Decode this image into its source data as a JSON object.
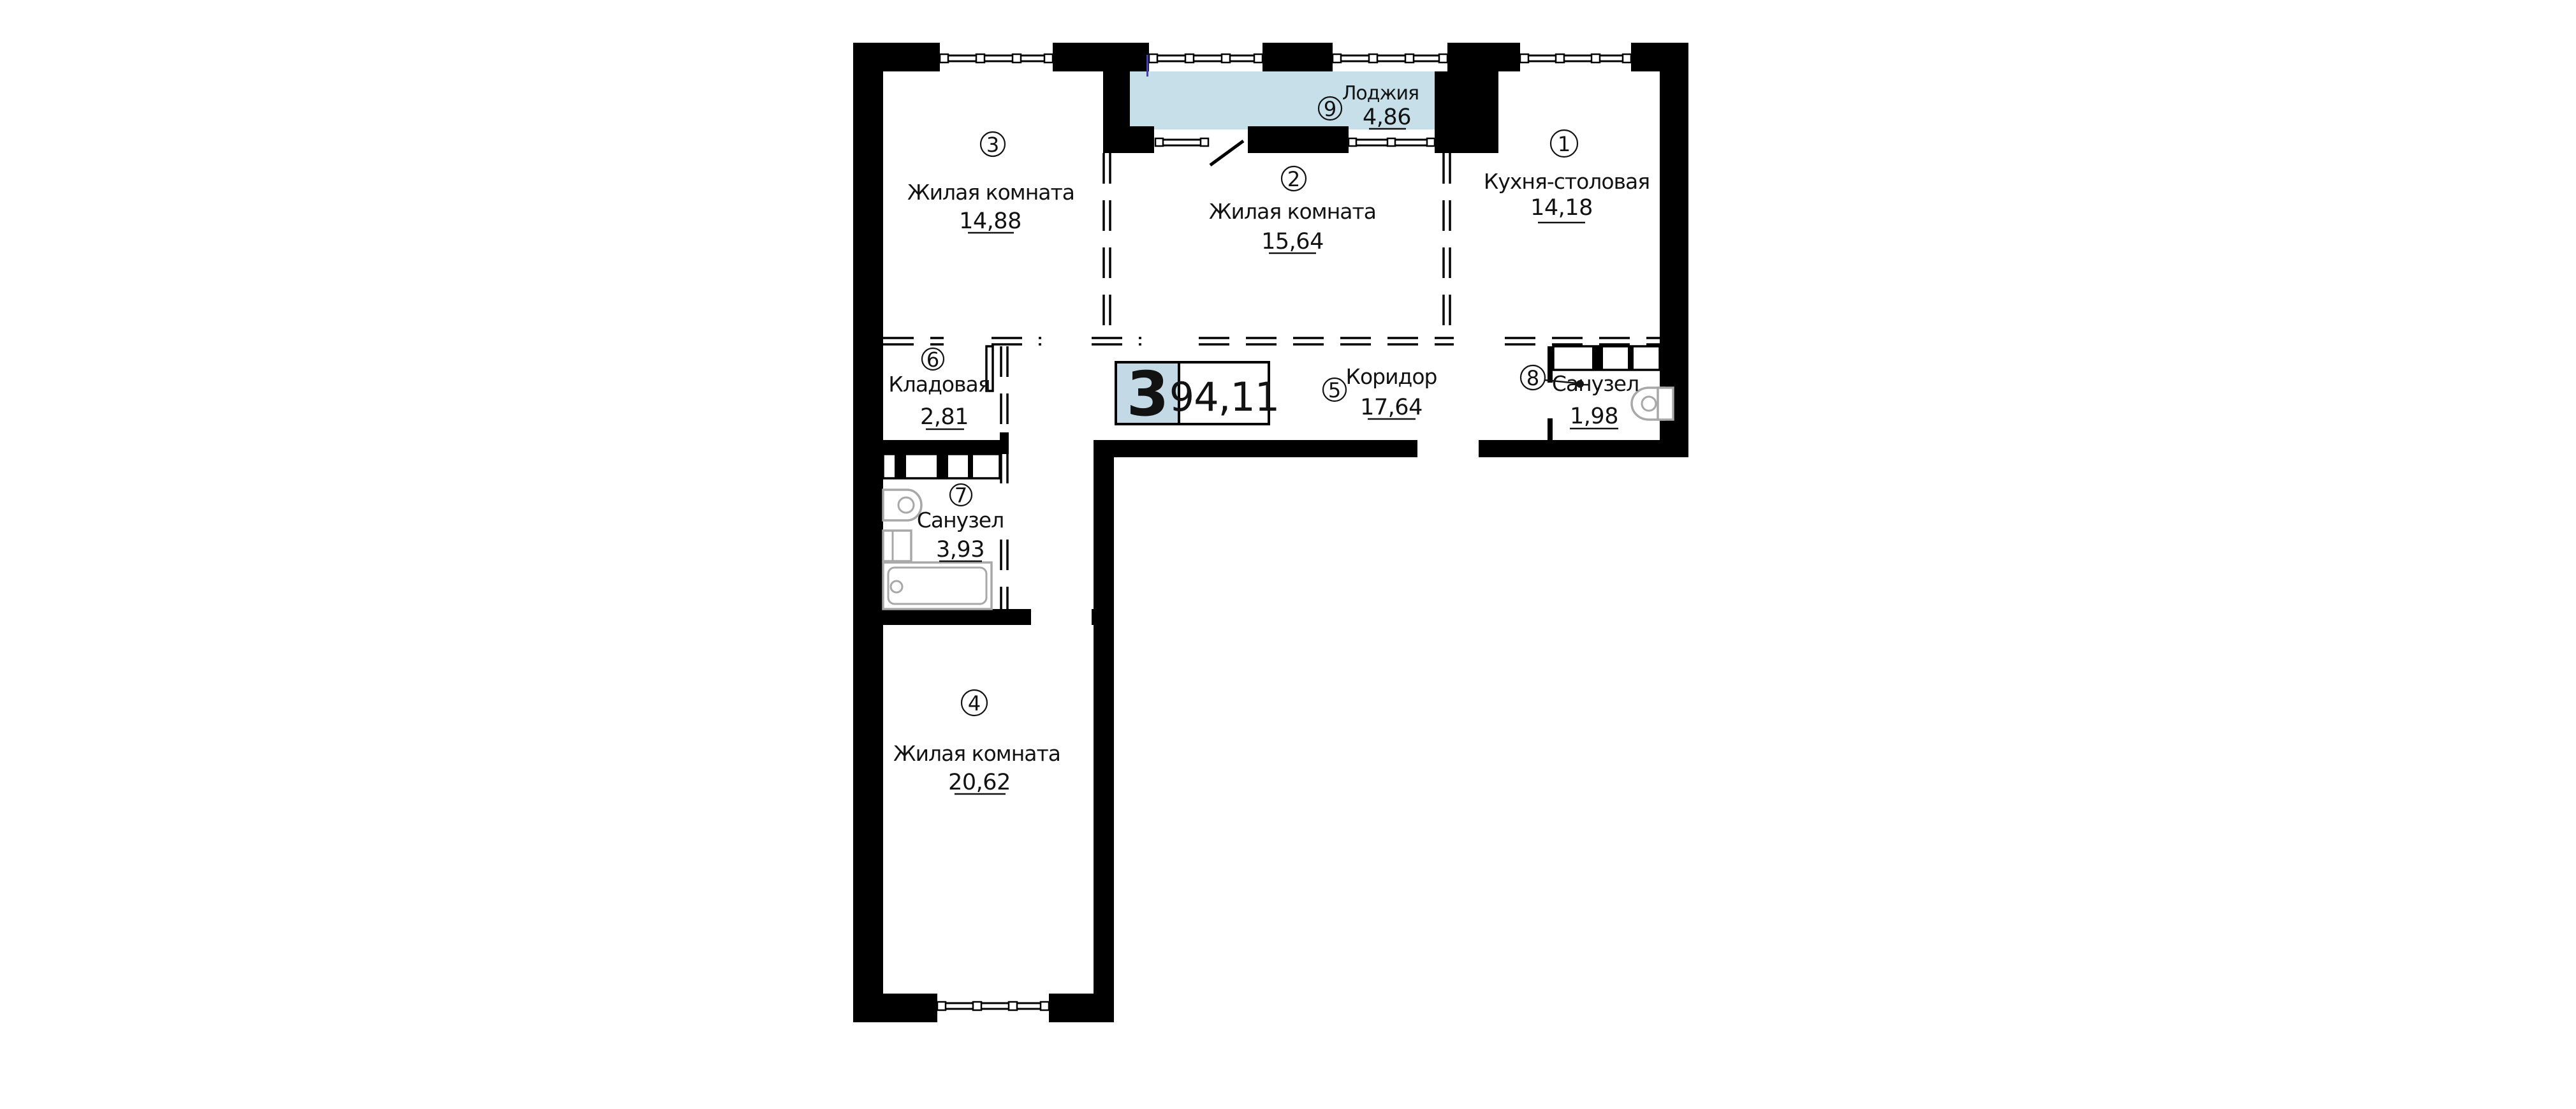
{
  "plan": {
    "type": "apartment-floor-plan",
    "badge": {
      "number": "3",
      "total_area": "94,11"
    },
    "rooms": [
      {
        "id": "1",
        "name": "Кухня-столовая",
        "area": "14,18"
      },
      {
        "id": "2",
        "name": "Жилая комната",
        "area": "15,64"
      },
      {
        "id": "3",
        "name": "Жилая комната",
        "area": "14,88"
      },
      {
        "id": "4",
        "name": "Жилая комната",
        "area": "20,62"
      },
      {
        "id": "5",
        "name": "Коридор",
        "area": "17,64"
      },
      {
        "id": "6",
        "name": "Кладовая",
        "area": "2,81"
      },
      {
        "id": "7",
        "name": "Санузел",
        "area": "3,93"
      },
      {
        "id": "8",
        "name": "Санузел",
        "area": "1,98"
      },
      {
        "id": "9",
        "name": "Лоджия",
        "area": "4,86"
      }
    ],
    "colors": {
      "wall": "#000000",
      "loggia_fill": "#c6dfe9",
      "badge_fill": "#c3dae6",
      "fixture_gray": "#a8a8a8"
    }
  }
}
